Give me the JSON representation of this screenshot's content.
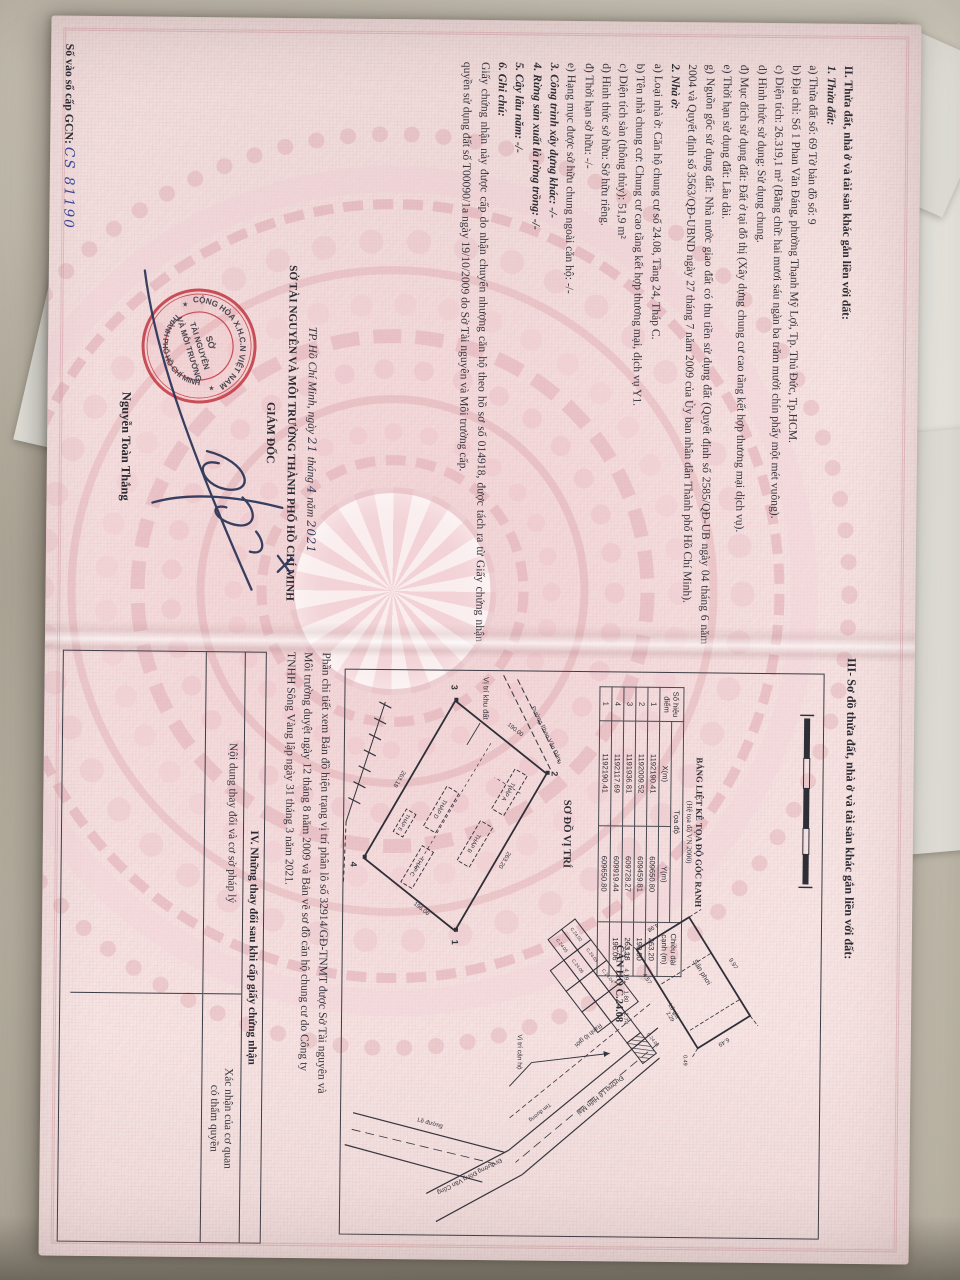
{
  "left_page": {
    "lines": [
      "II. Thửa đất, nhà ở và tài sản khác gắn liền với đất:",
      "1. Thửa đất:",
      "a) Thửa đất số: 69   Tờ bản đồ số: 9",
      "b) Địa chỉ: Số 1 Phan Văn Đáng, phường Thạnh Mỹ Lợi, Tp. Thủ Đức, Tp.HCM.",
      "c) Diện tích: 26.319,1 m² (Bằng chữ: hai mươi sáu ngàn ba trăm mười chín phẩy một mét vuông).",
      "d) Hình thức sử dụng: Sử dụng chung.",
      "đ) Mục đích sử dụng đất: Đất ở tại đô thị (Xây dựng chung cư cao tầng kết hợp thương mại dịch vụ).",
      "e) Thời hạn sử dụng đất: Lâu dài.",
      "g) Nguồn gốc sử dụng đất: Nhà nước giao đất có thu tiền sử dụng đất (Quyết định số 2585/QĐ-UB ngày 04 tháng 6 năm 2004 và Quyết định số 3563/QĐ-UBND ngày 27 tháng 7 năm 2009 của Ủy ban nhân dân Thành phố Hồ Chí Minh).",
      "2. Nhà ở:",
      "a) Loại nhà ở: Căn hộ chung cư số 24.08, Tầng 24, Tháp C.",
      "b) Tên nhà chung cư: Chung cư cao tầng kết hợp thương mại, dịch vụ Y1.",
      "c) Diện tích sàn (thông thủy): 51,9 m²",
      "d) Hình thức sở hữu: Sở hữu riêng.",
      "đ) Thời hạn sở hữu: -/-",
      "e) Hạng mục được sở hữu chung ngoài căn hộ: -/-",
      "3. Công trình xây dựng khác: -/-",
      "4. Rừng sản xuất là rừng trồng: -/-",
      "5. Cây lâu năm: -/-",
      "6. Ghi chú:",
      "Giấy chứng nhận này được cấp do nhận chuyển nhượng căn hộ theo hồ sơ số 014918, được tách ra từ Giấy chứng nhận quyền sử dụng đất số T00090/1a ngày 19/10/2009 do Sở Tài nguyên và Môi trường cấp."
    ],
    "sign": {
      "city_prefix": "TP. Hồ Chí Minh, ngày",
      "hw_day": "21",
      "word_month": "tháng",
      "hw_month": "4",
      "word_year": "năm",
      "hw_year": "2021",
      "authority": "SỞ TÀI NGUYÊN VÀ MÔI TRƯỜNG THÀNH PHỐ HỒ CHÍ MINH",
      "title": "GIÁM ĐỐC",
      "signer": "Nguyễn Toàn Thắng"
    },
    "stamp": {
      "arc_top": "CỘNG HÒA X.H.C.N VIỆT NAM",
      "arc_bottom": "THÀNH PHỐ HỒ CHÍ MINH",
      "star_left": "★",
      "star_right": "★",
      "center1": "SỞ",
      "center2": "TÀI NGUYÊN",
      "center3": "VÀ MÔI TRƯỜNG"
    },
    "book": {
      "label": "Số vào sổ cấp GCN:",
      "value": "CS 81190"
    }
  },
  "right_page": {
    "heading": "III- Sơ đồ thửa đất, nhà ở và tài sản khác gắn liền với đất:",
    "coord_table": {
      "title": "BẢNG LIỆT KÊ TỌA ĐỘ GÓC RANH",
      "subtitle": "(Hệ tọa độ VN 2000)",
      "col_point_1": "Số hiệu",
      "col_point_2": "điểm",
      "col_coord": "Tọa độ",
      "col_x": "X(m)",
      "col_y": "Y(m)",
      "col_len_1": "Chiều dài",
      "col_len_2": "cạnh (m)",
      "rows": [
        {
          "n": "1",
          "x": "1192190.41",
          "y": "609650.80",
          "d": "263.20"
        },
        {
          "n": "2",
          "x": "1192009.52",
          "y": "609459.81",
          "d": "190.00"
        },
        {
          "n": "3",
          "x": "1191936.81",
          "y": "609728.27",
          "d": "263.18"
        },
        {
          "n": "4",
          "x": "1192117.69",
          "y": "609919.44",
          "d": "196.06"
        },
        {
          "n": "1",
          "x": "1192190.41",
          "y": "609650.80",
          "d": ""
        }
      ]
    },
    "site_plan": {
      "title": "SƠ ĐỒ VỊ TRÍ",
      "area_label": "Vị trí khu đất",
      "road": "Đường Phan Văn Đáng",
      "towers": [
        "THÁP A",
        "THÁP B",
        "THÁP D",
        "THÁP C",
        "THÁP E"
      ],
      "corners": [
        "2",
        "1",
        "4",
        "3"
      ],
      "lengths": [
        "263.20",
        "196.06",
        "263.18",
        "190.00"
      ]
    },
    "unit_plan": {
      "title": "CĂN HỘ C.24.08",
      "label_balcony": "Sân phơi",
      "label_loggia": "Lô gia",
      "dims": [
        "9.97",
        "4.98",
        "6.49",
        "4.57",
        "2.29",
        "3.27",
        "4.19",
        "1.80",
        "2.74",
        "0.49"
      ]
    },
    "floor_plan": {
      "units": [
        "C.24.02",
        "C.24.03",
        "C.24.04",
        "C.24.05",
        "C.24.06",
        "C.24.08"
      ],
      "road1": "Đường Lê Hiến Mai",
      "road2": "Đi đường Đồng Văn Cống",
      "boundary": "Ranh lộ giới",
      "unit_pointer": "Vị trí căn hộ",
      "curb": "Lề đường",
      "axis": "Tim đường"
    },
    "note_lines": [
      "Phần chi tiết xem Bản đồ hiện trạng vị trí phân lô số 32914/GĐ-TNMT được Sở Tài nguyên và",
      "Môi trường duyệt ngày 12 tháng 8 năm 2009 và Bản vẽ sơ đồ căn hộ chung cư do Công ty",
      "TNHH Sông Vàng lập ngày 31 tháng 3 năm 2021."
    ],
    "section4": {
      "title": "IV. Những thay đổi sau khi cấp giấy chứng nhận",
      "col_left": "Nội dung thay đổi và cơ sở pháp lý",
      "col_right_1": "Xác nhận của cơ quan",
      "col_right_2": "có thẩm quyền"
    }
  }
}
